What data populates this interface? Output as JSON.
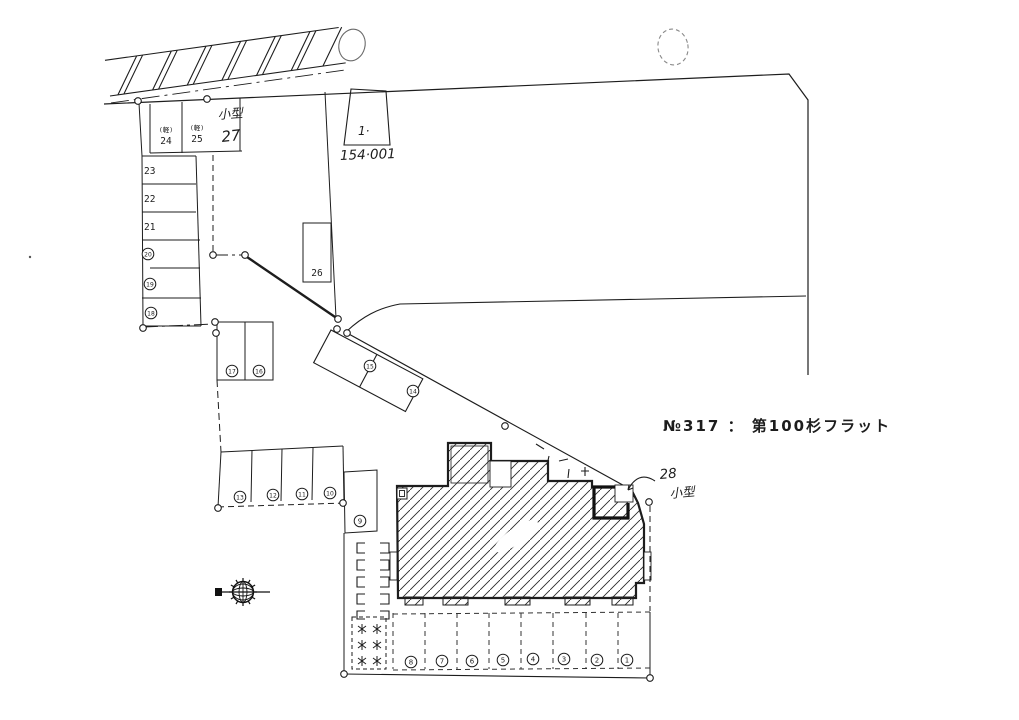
{
  "header": {
    "title_line": "№317 ： 第100杉フラット"
  },
  "parcel": {
    "lot_no": "1·",
    "lot_area": "154·001"
  },
  "labels": {
    "kei": "(軽)",
    "kogata": "小型"
  },
  "spaces": {
    "c1": "1",
    "c2": "2",
    "c3": "3",
    "c4": "4",
    "c5": "5",
    "c6": "6",
    "c7": "7",
    "c8": "8",
    "c9": "9",
    "c10": "10",
    "c11": "11",
    "c12": "12",
    "c13": "13",
    "c14": "14",
    "c15": "15",
    "c16": "16",
    "c17": "17",
    "c18": "18",
    "c19": "19",
    "c20": "20",
    "n21": "21",
    "n22": "22",
    "n23": "23",
    "n24": "24",
    "n25": "25",
    "n26": "26",
    "n27": "27",
    "n28": "28"
  },
  "icons": {
    "compass": "north-compass"
  },
  "colors": {
    "ink": "#1d1d1d",
    "paper": "#ffffff"
  }
}
